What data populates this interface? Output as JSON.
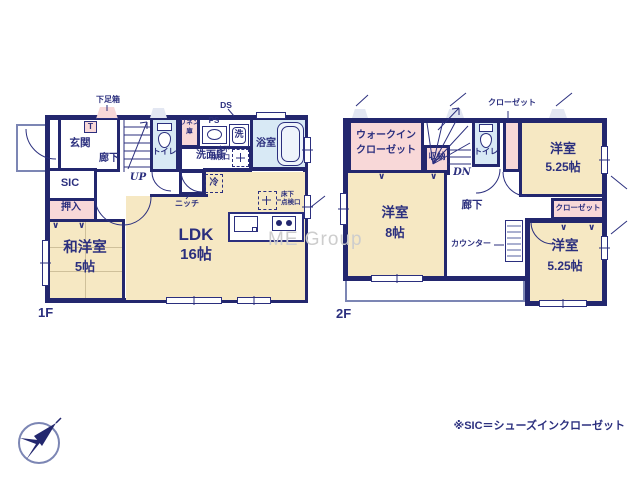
{
  "watermark": "ME Group",
  "footnote": "※SIC＝シューズインクローゼット",
  "colors": {
    "wall": "#23276e",
    "room_cream": "#f6e8c3",
    "closet_pink": "#f8d8d8",
    "wet_blue": "#d8e9f5",
    "text": "#2b2f7e"
  },
  "f1": {
    "floor": "1F",
    "getabako": "下足箱",
    "t": "T",
    "genkan": "玄関",
    "rouka": "廊下",
    "up": "UP",
    "toire": "トイレ",
    "linen1": "リネン",
    "linen2": "庫",
    "ps": "PS",
    "ds": "DS",
    "sen": "洗",
    "senmenjo": "洗面所",
    "yokushitsu": "浴室",
    "yukashita1": "床下",
    "yukashita2": "点検口",
    "rei": "冷",
    "niche": "ニッチ",
    "sic": "SIC",
    "oshiire": "押入",
    "wayou": "和洋室",
    "wayou_size": "5帖",
    "ldk": "LDK",
    "ldk_size": "16帖"
  },
  "f2": {
    "floor": "2F",
    "wic1": "ウォークイン",
    "wic2": "クローゼット",
    "shuunou": "収納",
    "dn": "DN",
    "toire": "トイレ",
    "closet": "クローゼット",
    "rouka": "廊下",
    "counter": "カウンター",
    "room_tr": "洋室",
    "room_tr_size": "5.25帖",
    "room_l": "洋室",
    "room_l_size": "8帖",
    "room_br": "洋室",
    "room_br_size": "5.25帖",
    "closet_br": "クローゼット"
  }
}
